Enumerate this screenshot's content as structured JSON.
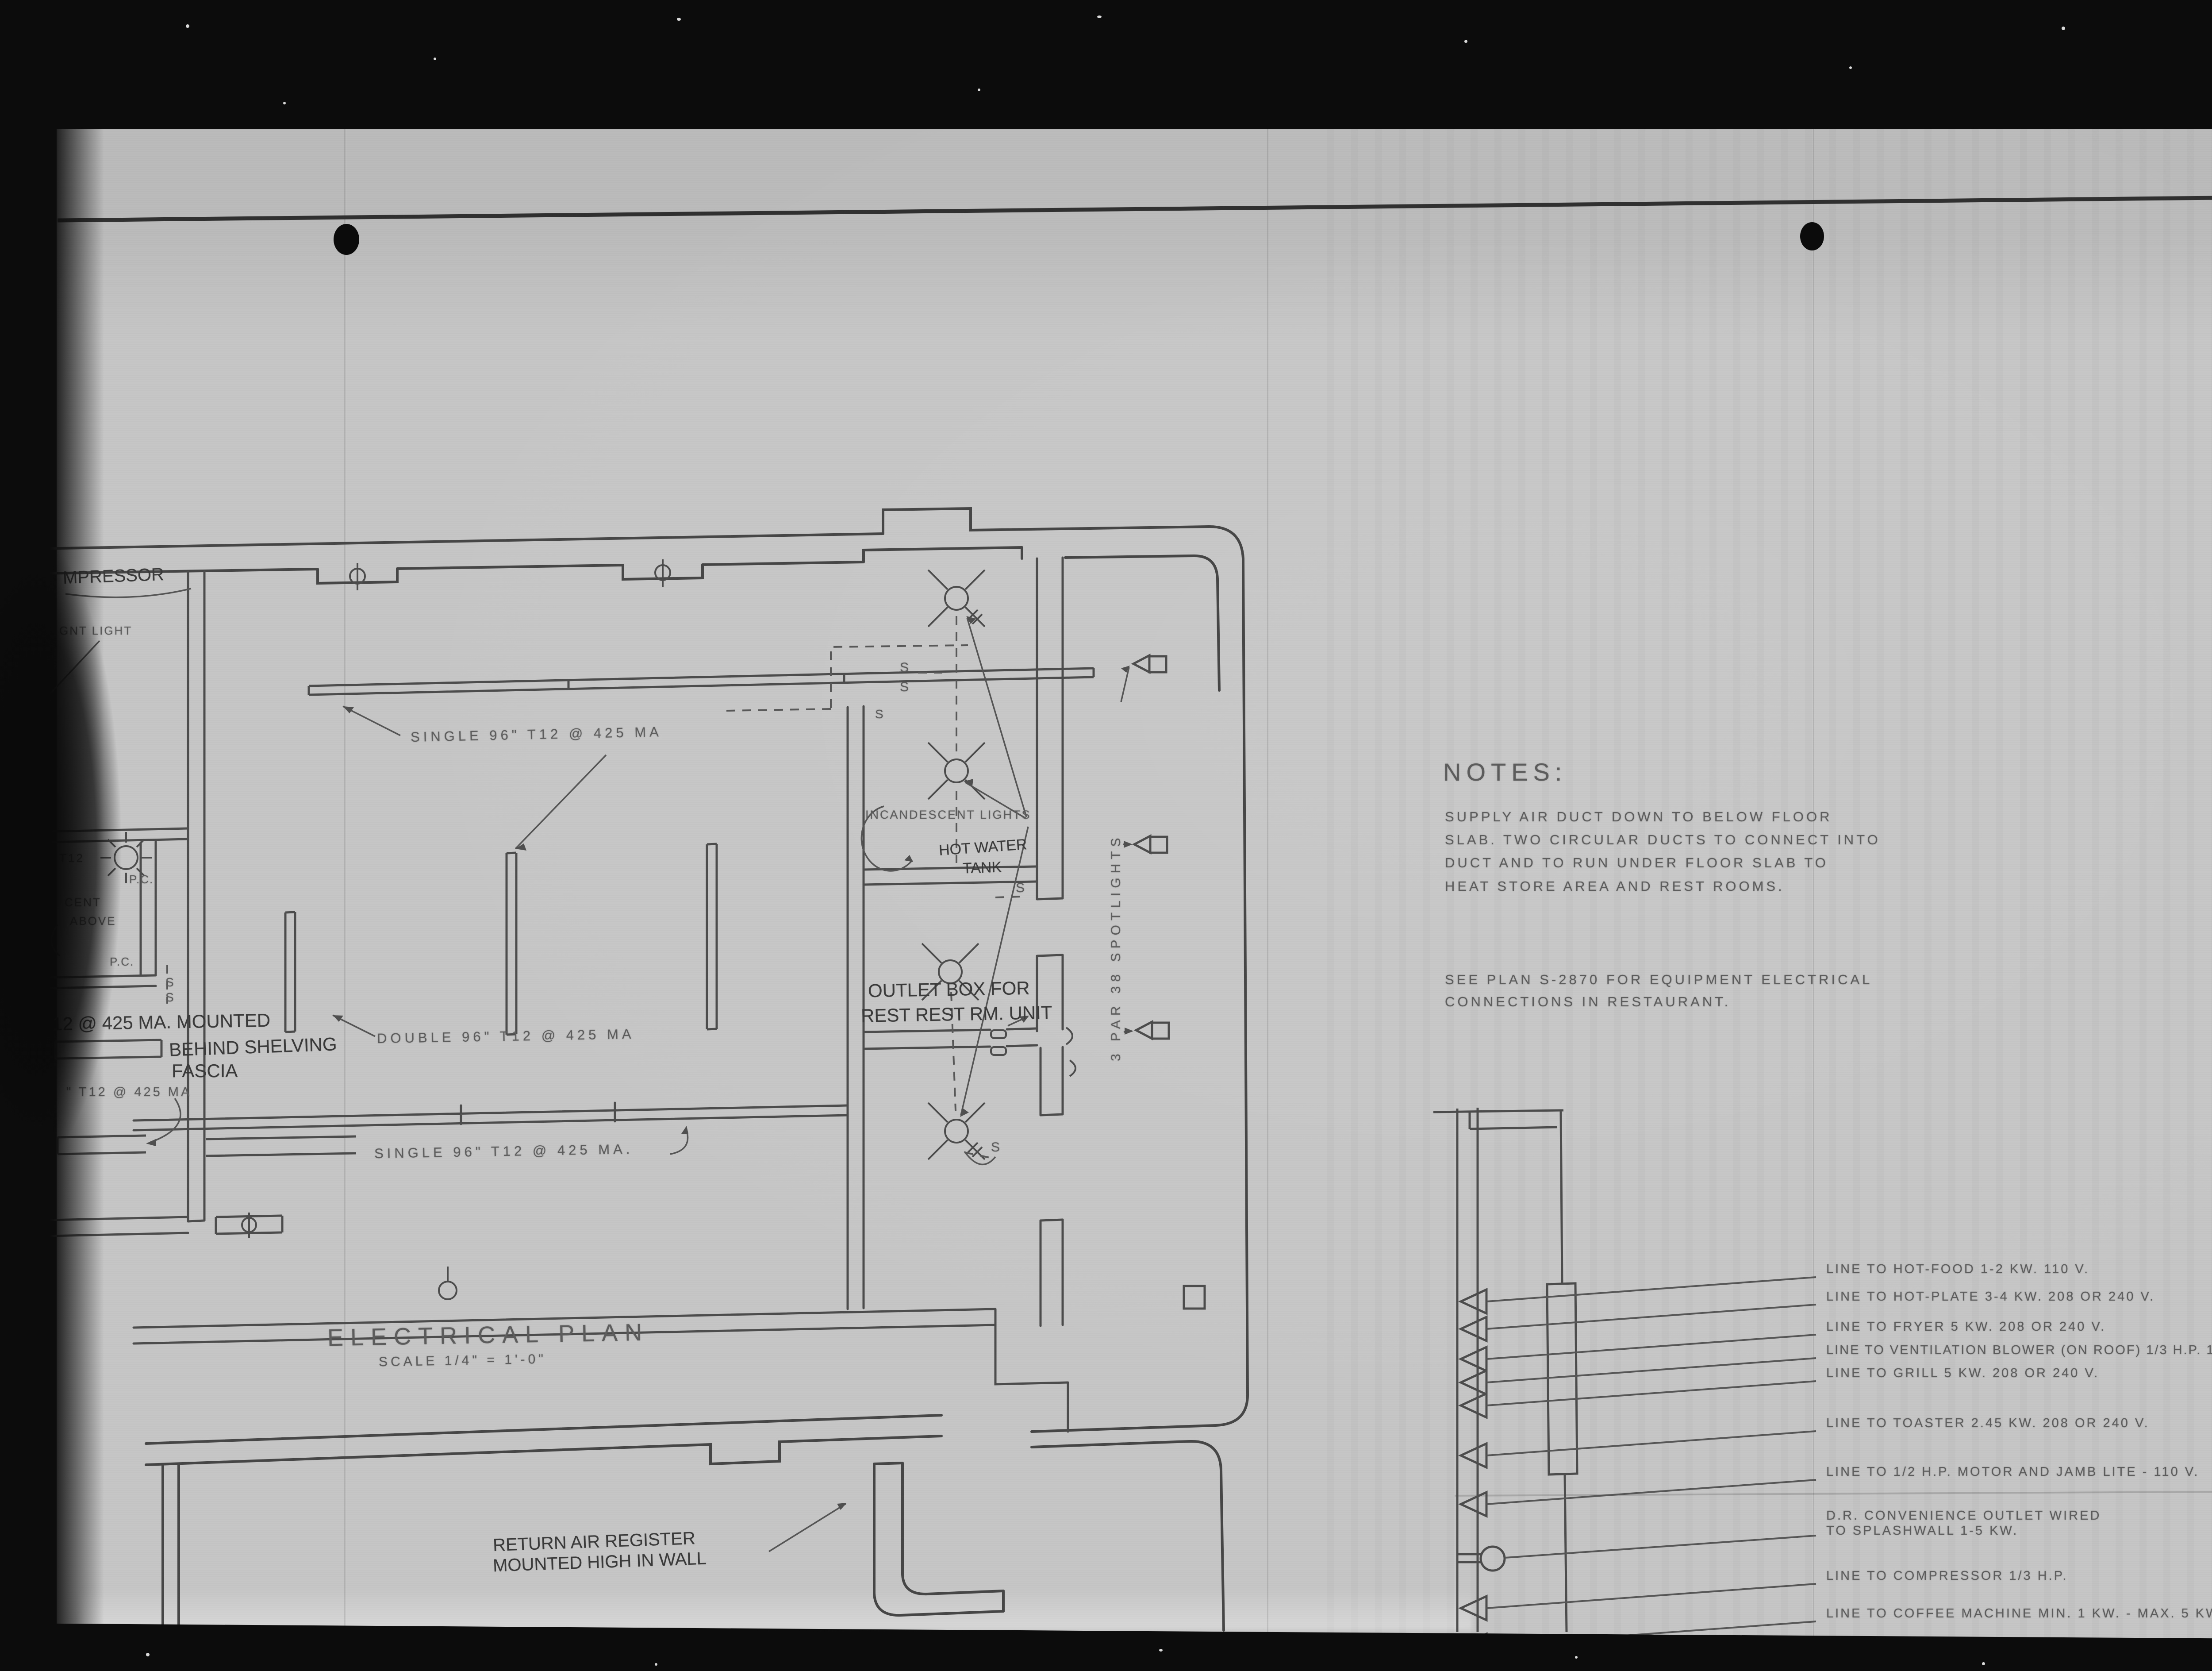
{
  "film": {
    "page_tag": "2 of/de"
  },
  "title_block": {
    "title": "ELECTRICAL PLAN",
    "scale": "SCALE  1/4\" = 1'-0\""
  },
  "notes": {
    "heading": "NOTES:",
    "note1": [
      "SUPPLY AIR DUCT DOWN TO BELOW FLOOR",
      "SLAB. TWO CIRCULAR DUCTS TO CONNECT INTO",
      "DUCT AND TO RUN UNDER FLOOR SLAB TO",
      "HEAT STORE AREA AND REST ROOMS."
    ],
    "note2": [
      "SEE PLAN S-2870 FOR EQUIPMENT ELECTRICAL",
      "CONNECTIONS IN RESTAURANT."
    ]
  },
  "plan": {
    "fixtures": {
      "single_upper": "SINGLE 96\" T12 @ 425 MA",
      "double": "DOUBLE 96\" T12 @ 425 MA",
      "single_lower": "SINGLE 96\" T12 @ 425 MA.",
      "t12_partial": "\" T12 @ 425 MA",
      "t12_small": "T12"
    },
    "handwritten": {
      "mounted1": "12 @ 425 MA. MOUNTED",
      "mounted2": "BEHIND SHELVING",
      "mounted3": "FASCIA",
      "outlet1": "OUTLET BOX FOR",
      "outlet2": "REST REST RM. UNIT",
      "hot_water1": "HOT WATER",
      "hot_water2": "TANK",
      "return_air1": "RETURN AIR REGISTER",
      "return_air2": "MOUNTED HIGH IN WALL",
      "compressor": "MPRESSOR"
    },
    "labels": {
      "incandescent": "INCANDESCENT LIGHTS",
      "spotlights": "3 PAR 38 SPOTLIGHTS",
      "ent_light": "GNT LIGHT",
      "cent": "CENT",
      "above": "ABOVE",
      "pc": "P.C.",
      "switch": "S"
    }
  },
  "panel": {
    "hot_food": "LINE TO HOT-FOOD 1-2 KW. 110 V.",
    "hot_plate": "LINE TO HOT-PLATE 3-4 KW. 208 OR 240 V.",
    "fryer": "LINE TO FRYER 5 KW. 208 OR 240 V.",
    "vent_blower": "LINE TO VENTILATION BLOWER (ON ROOF) 1/3 H.P. 110 V.",
    "grill": "LINE TO GRILL 5 KW. 208 OR 240 V.",
    "toaster": "LINE TO TOASTER 2.45 KW. 208 OR 240 V.",
    "motor_jamb": "LINE TO 1/2 H.P. MOTOR AND JAMB LITE - 110 V.",
    "dr1": "D.R. CONVENIENCE OUTLET WIRED",
    "dr2": "TO SPLASHWALL 1-5 KW.",
    "compressor": "LINE TO COMPRESSOR 1/3 H.P.",
    "coffee": "LINE TO COFFEE MACHINE MIN. 1 KW. - MAX. 5 KW."
  },
  "colors": {
    "film": "#0b0b0b",
    "paper": "#c6c6c6",
    "pencil": "#5c5c5c",
    "ink": "#303030",
    "tag": "#f1efe8"
  }
}
